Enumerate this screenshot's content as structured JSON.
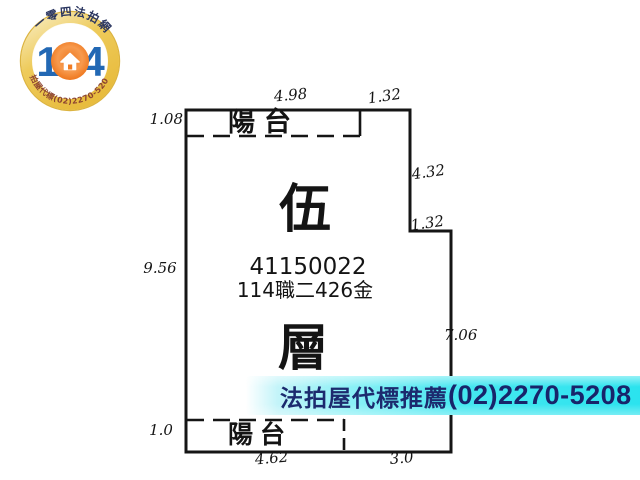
{
  "logo": {
    "arc_top_text": "一零四法拍網",
    "arc_bottom_text": "法拍屋代標(02)2270-5208",
    "digit_left": "1",
    "digit_right": "4",
    "colors": {
      "ring_gold": "#ecc24a",
      "digits_blue": "#2268b4",
      "ball_orange": "#f07c24",
      "arc_top_color": "#2b3660",
      "arc_bottom_color": "#8d4431"
    }
  },
  "plan": {
    "balcony_top_label": "陽台",
    "balcony_bottom_label": "陽台",
    "floor_label_upper": "伍",
    "floor_label_lower": "層",
    "case_number": "41150022",
    "case_reference": "114職二426金",
    "dimensions": {
      "top_balcony_width": "4.98",
      "top_right_width": "1.32",
      "left_balcony_depth": "1.08",
      "right_upper_height": "4.32",
      "right_step_width": "1.32",
      "left_height": "9.56",
      "right_lower_height": "7.06",
      "bottom_balcony_depth": "1.0",
      "bottom_left_width": "4.62",
      "bottom_right_width": "3.0"
    },
    "line_color": "#151515"
  },
  "promo": {
    "text": "法拍屋代標推薦",
    "phone": "(02)2270-5208",
    "text_color": "#1c2a6e",
    "band_color": "#2be3ee"
  }
}
